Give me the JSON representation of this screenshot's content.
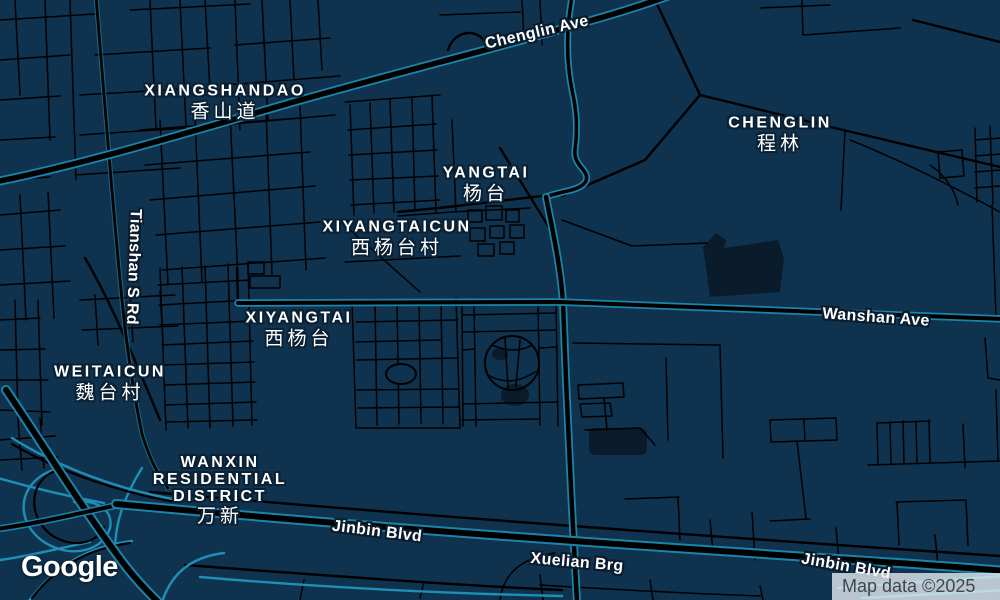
{
  "map": {
    "provider_logo": "Google",
    "attribution": "Map data ©2025",
    "theme": "dark",
    "colors": {
      "background": "#0f334f",
      "road_fill": "#000000",
      "major_road_casing": "#1c84a8",
      "interchange_ramp": "#1e8fb5",
      "building_fill": "#0a1c2c",
      "label_text": "#ffffff",
      "label_halo": "#0b2133",
      "attribution_text": "#42464b",
      "attribution_background": "rgba(233,239,244,0.78)"
    },
    "place_labels": [
      {
        "name": "XIANGSHANDAO",
        "cjk": "香山道"
      },
      {
        "name": "YANGTAI",
        "cjk": "杨台"
      },
      {
        "name": "XIYANGTAICUN",
        "cjk": "西杨台村"
      },
      {
        "name": "CHENGLIN",
        "cjk": "程林"
      },
      {
        "name": "XIYANGTAI",
        "cjk": "西杨台"
      },
      {
        "name": "WEITAICUN",
        "cjk": "魏台村"
      },
      {
        "lines": [
          "WANXIN",
          "RESIDENTIAL",
          "DISTRICT"
        ],
        "cjk": "万新"
      }
    ],
    "road_labels": [
      {
        "name": "Chenglin Ave"
      },
      {
        "name": "Wanshan Ave"
      },
      {
        "name": "Jinbin Blvd"
      },
      {
        "name": "Xuelian Brg"
      },
      {
        "name": "Jinbin Blvd"
      },
      {
        "name": "Tianshan S Rd"
      }
    ]
  }
}
